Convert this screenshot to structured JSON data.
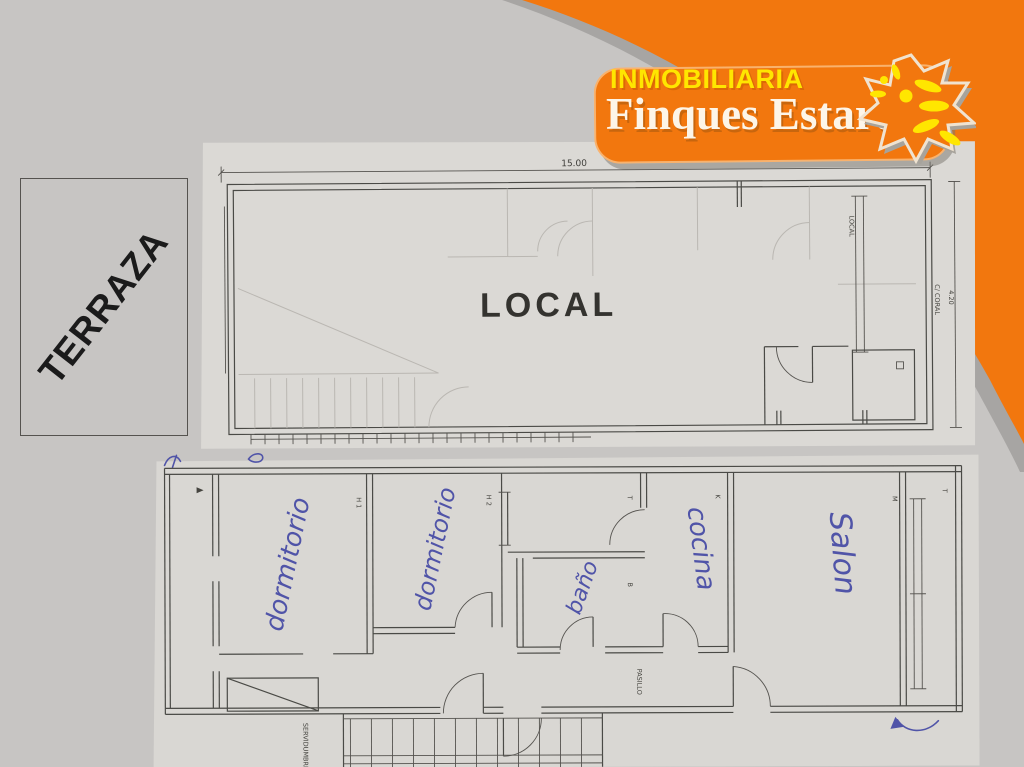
{
  "colors": {
    "background": "#c7c5c3",
    "brand_orange": "#f2770e",
    "brand_yellow": "#ffe600",
    "logo_cream": "#fdf5e8",
    "paper": "#dbd9d5",
    "plan_line": "#4a4a46",
    "ink_blue": "#5054a8",
    "curve_shadow": "#a7a5a3"
  },
  "logo": {
    "tagline": "INMOBILIARIA",
    "name": "Finques Estartit",
    "sun_icon": "sun-burst-icon"
  },
  "terrace": {
    "label": "TERRAZA"
  },
  "plan_top": {
    "title": "LOCAL",
    "top_dimension": "15.00",
    "right_dimension": "4.20",
    "street_label": "C/ CORAL",
    "unit_label": "LOCAL"
  },
  "plan_bottom": {
    "rooms": [
      {
        "code": "H 1",
        "name": "dormitorio"
      },
      {
        "code": "H 2",
        "name": "dormitorio"
      },
      {
        "code": "B",
        "name": "baño"
      },
      {
        "code": "K",
        "name": "cocina"
      },
      {
        "code": "M",
        "name": "Salon"
      }
    ],
    "hall_code": "T",
    "window_code": "T",
    "corridor_label": "PASILLO",
    "easement_label": "SERVIDUMBRE"
  }
}
